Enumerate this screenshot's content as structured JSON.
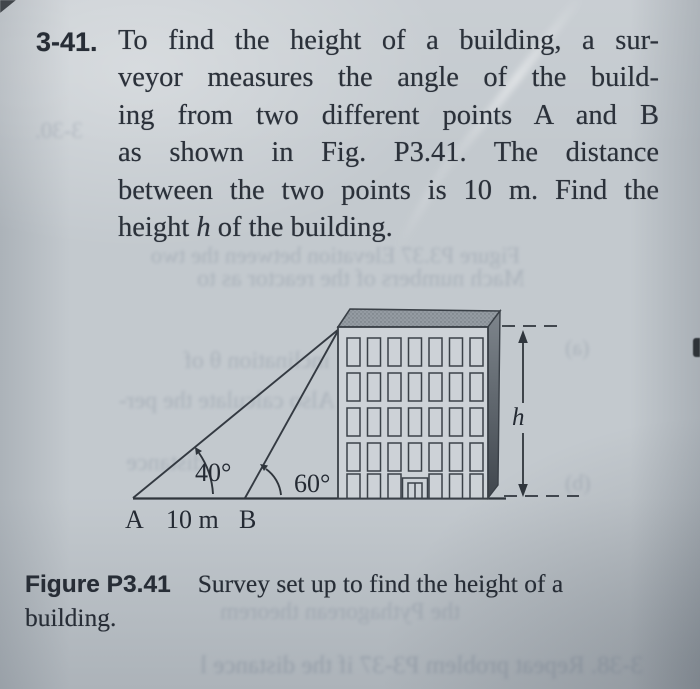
{
  "page": {
    "bg_color": "#c3c9ce",
    "ink_color": "#2b313a",
    "roof_gray": "#949ba2",
    "side_gray_top": "#7e858c",
    "side_gray_bottom": "#40464d",
    "figure_line_color": "#343a42"
  },
  "problem": {
    "number": "3-41.",
    "lines": [
      "To find the height of a building, a sur-",
      "veyor measures the angle of the build-",
      "ing from two different points A and B",
      "as shown in Fig. P3.41. The distance",
      "between the two points is 10 m. Find the"
    ],
    "last_line": {
      "pre": "height ",
      "italic": "h",
      "post": " of the building."
    }
  },
  "figure": {
    "labels": {
      "angle_a": "40°",
      "angle_b": "60°",
      "point_a": "A",
      "point_b": "B",
      "distance": "10 m",
      "height": "h"
    }
  },
  "caption": {
    "label": "Figure P3.41",
    "line1": "Survey set up to find the height of a",
    "line2": "building."
  },
  "bleedthrough": {
    "fig37_caption": "Figure P3.37   Elevation between the two",
    "fig37_caption2": "Mach numbers of the reactor as to",
    "margin_number": "3-30.",
    "left1": "inclination θ of",
    "left2": "Also calculate the per-",
    "left3": "distance",
    "part_a": "(a)",
    "part_b": "(b)",
    "caption_area": "the Pythagorean theorem",
    "bottom_line": "3-38. Repeat problem P3-37 if the distance l"
  }
}
